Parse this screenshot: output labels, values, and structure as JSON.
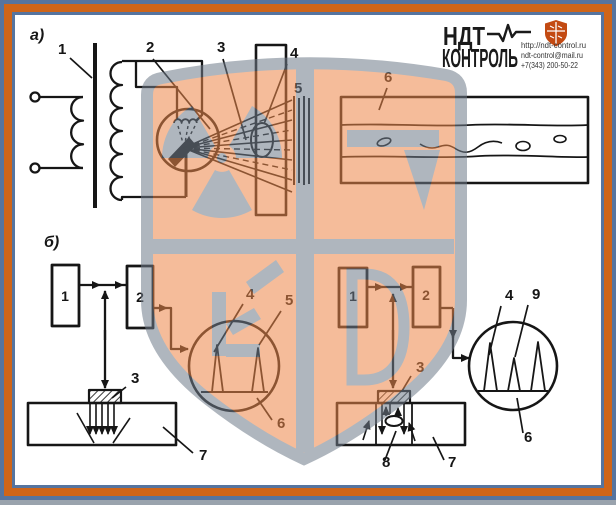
{
  "colors": {
    "frame_orange": "#cf6519",
    "frame_blue": "#56749f",
    "paper": "#ffffff",
    "line": "#161616",
    "watermark_fill": "#ed8749",
    "watermark_gray": "#6f7b89",
    "logo_shield_orange": "#c34a12"
  },
  "logo": {
    "brand_line1": "НДТ",
    "brand_line2": "КОНТРОЛЬ",
    "website": "http://ndt-control.ru",
    "email": "ndt-control@mail.ru",
    "phone": "+7(343) 200-50-22"
  },
  "part_a": {
    "section_label": "а)",
    "callouts": {
      "transformer": "1",
      "tube": "2",
      "beam": "3",
      "object": "4",
      "film": "5",
      "radiograph": "6"
    }
  },
  "part_b": {
    "section_label": "б)",
    "shadow_method": {
      "box_generator": "1",
      "box_receiver": "2",
      "transducer": "3",
      "initial_pulse": "4",
      "through_pulse": "5",
      "screen": "6",
      "workpiece": "7"
    },
    "echo_method": {
      "box_generator": "1",
      "box_receiver": "2",
      "transducer": "3",
      "initial_pulse": "4",
      "defect_echo": "9",
      "screen": "6",
      "workpiece": "7",
      "defect": "8"
    }
  }
}
